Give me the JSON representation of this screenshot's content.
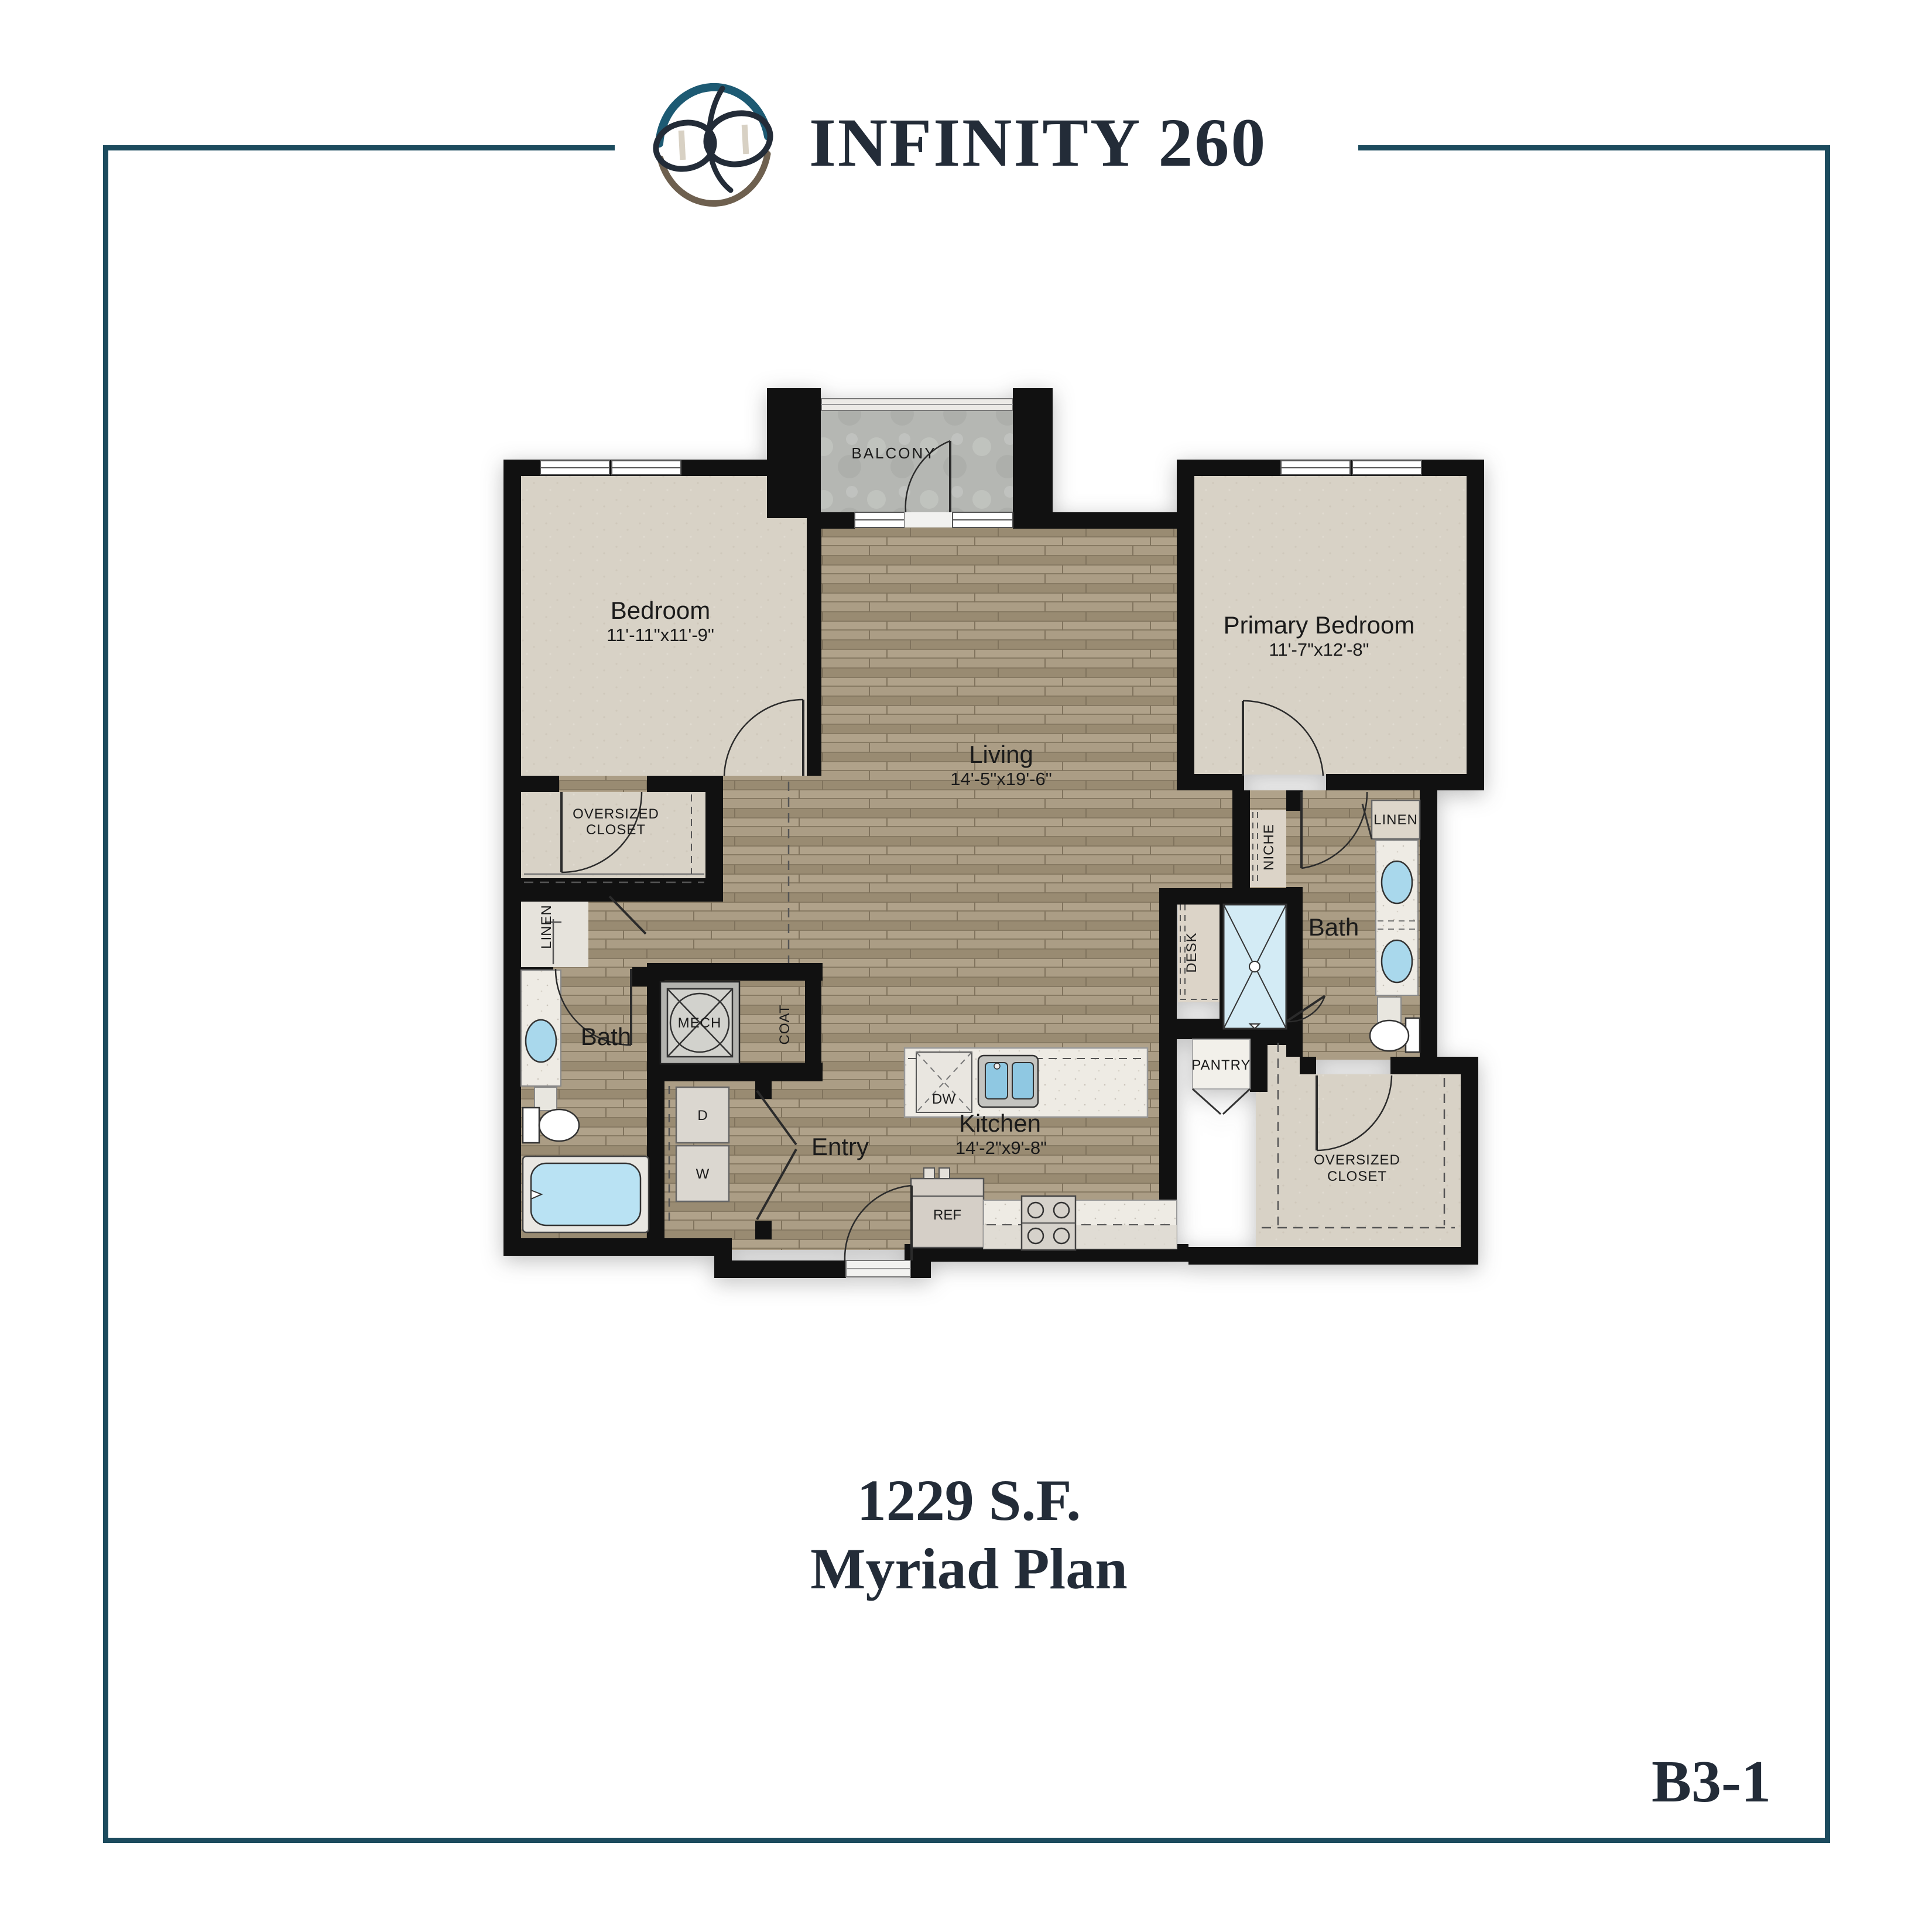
{
  "header": {
    "title": "INFINITY 260"
  },
  "colors": {
    "border": "#1c4b5e",
    "header_line": "#1d566e",
    "title_text": "#232c38",
    "logo_teal": "#1d5a73",
    "logo_brown": "#6e604f",
    "logo_navy": "#232c38",
    "wall": "#111111",
    "carpet": "#d8d2c6",
    "wood": "#a5977e",
    "concrete": "#b7b9b5",
    "water": "#a9d8ec"
  },
  "plan": {
    "balcony": "BALCONY",
    "bedroom": {
      "label": "Bedroom",
      "dims": "11'-11\"x11'-9\""
    },
    "primary_bedroom": {
      "label": "Primary Bedroom",
      "dims": "11'-7\"x12'-8\""
    },
    "living": {
      "label": "Living",
      "dims": "14'-5\"x19'-6\""
    },
    "kitchen": {
      "label": "Kitchen",
      "dims": "14'-2\"x9'-8\""
    },
    "entry": "Entry",
    "bath_left": "Bath",
    "bath_right": "Bath",
    "closet_left": {
      "line1": "OVERSIZED",
      "line2": "CLOSET"
    },
    "closet_right": {
      "line1": "OVERSIZED",
      "line2": "CLOSET"
    },
    "linen_left": "LINEN",
    "linen_right": "LINEN",
    "mech": "MECH",
    "coat": "COAT",
    "niche": "NICHE",
    "desk": "DESK",
    "pantry": "PANTRY",
    "dishwasher": "DW",
    "dryer": "D",
    "washer": "W",
    "fridge": "REF"
  },
  "footer": {
    "area": "1229 S.F.",
    "plan_name": "Myriad Plan",
    "plan_code": "B3-1"
  }
}
